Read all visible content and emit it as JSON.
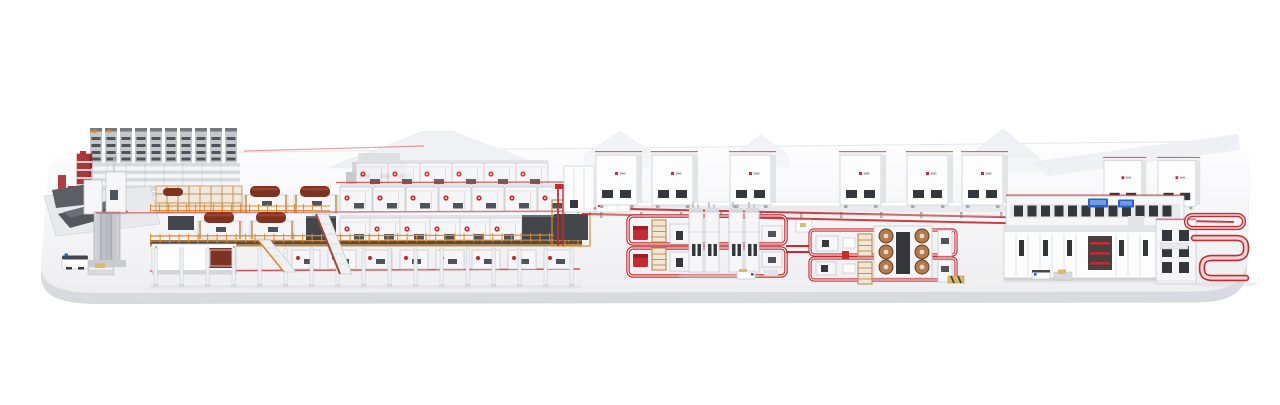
{
  "scene": {
    "title": "isometric 3D render of a complete industrial production line on a rounded white platform",
    "background_color": "#ffffff",
    "visible_text": [],
    "palette": {
      "background": "#ffffff",
      "platform_top": "#f6f6f8",
      "platform_side": "#e7e7ea",
      "machine_white": "#f6f6f8",
      "machine_light": "#fdfdfe",
      "machine_outline": "#c7c9ce",
      "machine_shade": "#e2e3e7",
      "structure_gray": "#c3c6ca",
      "structure_mid": "#a7abb0",
      "dark_panel": "#43464b",
      "window_dark": "#34373c",
      "slot_dark": "#4f545a",
      "accent_red": "#c52b30",
      "accent_red_soft": "#f0d6d7",
      "maroon": "#7e3322",
      "orange": "#df8a2f",
      "wood": "#c49257",
      "copper": "#b5794a",
      "copper_dark": "#5e4025",
      "screen_blue": "#2e62c8",
      "pallet_yellow": "#d9b96a",
      "shadow": "#d9dade"
    },
    "sections": [
      {
        "id": "platform",
        "description": "rounded white display slab"
      },
      {
        "id": "storage-rack-towers",
        "description": "tall gray roll-storage racks, far left"
      },
      {
        "id": "red-rack-tower",
        "description": "red vertical rack with white shelf bands"
      },
      {
        "id": "splicing-station",
        "description": "gray splice table with dark sheets, mast machines, AGV and pallet"
      },
      {
        "id": "corrugator-bridge",
        "description": "two-tier elevated line: wood/roll stands left, white modules with red valves right, orange railings, support columns, staircases"
      },
      {
        "id": "background-hall-roofs",
        "description": "faint white peaked roofs behind the line"
      },
      {
        "id": "electrical-cabinets-row",
        "description": "row of large white cabinets with red roof trim and dark vents"
      },
      {
        "id": "floor-conveyor-loop-1",
        "description": "red-railed floor loop with process towers, ladders and red carts"
      },
      {
        "id": "floor-conveyor-loop-2",
        "description": "red-railed floor loop with copper-roll winder block"
      },
      {
        "id": "finishing-line",
        "description": "right machine complex with window band and blue HMI screens"
      },
      {
        "id": "red-serpentine-track",
        "description": "red pill loop and S-shaped conveyor track at far right"
      }
    ],
    "counts": {
      "rack_towers": 10,
      "bridge_upper_modules": 7,
      "bridge_mid_modules": 6,
      "bridge_floor_modules": 8,
      "support_columns": 17,
      "cabinets": 8,
      "floor_loops": 2,
      "process_towers": 4,
      "copper_rolls": 6,
      "blue_screens": 2,
      "agvs": 3
    }
  }
}
